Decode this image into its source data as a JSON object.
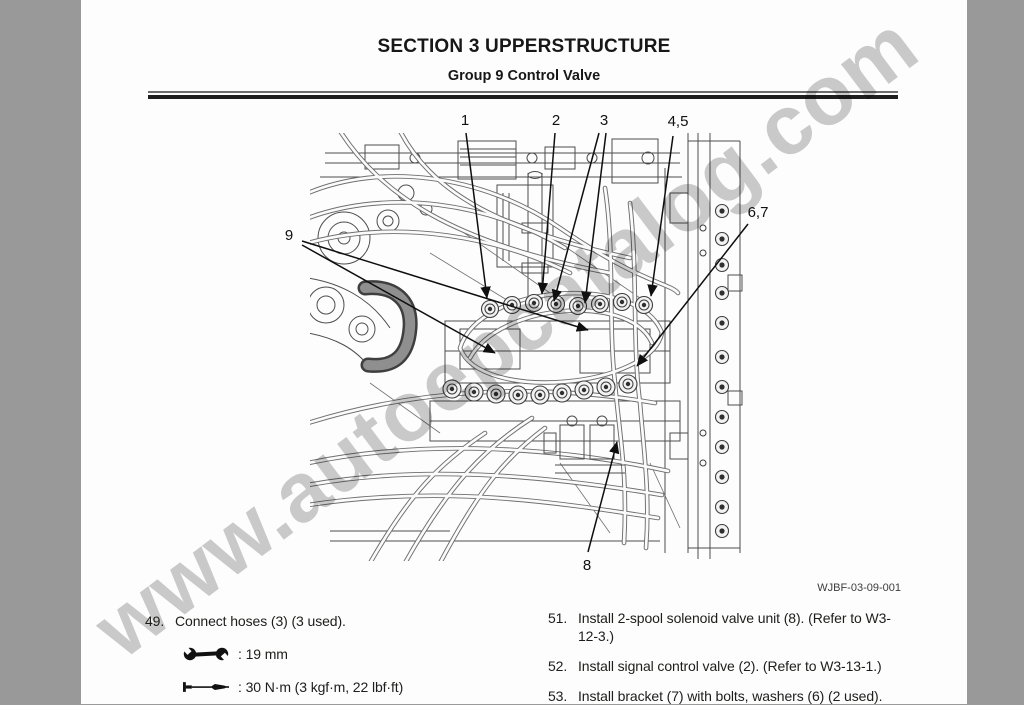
{
  "header": {
    "section_title": "SECTION 3 UPPERSTRUCTURE",
    "group_title": "Group 9 Control Valve"
  },
  "watermark": "www.autoepcatalog.com",
  "figure": {
    "code": "WJBF-03-09-001",
    "callouts": [
      {
        "label": "1"
      },
      {
        "label": "2"
      },
      {
        "label": "3"
      },
      {
        "label": "4,5"
      },
      {
        "label": "6,7"
      },
      {
        "label": "8"
      },
      {
        "label": "9"
      }
    ]
  },
  "steps": {
    "left": [
      {
        "number": "49.",
        "text": "Connect hoses (3) (3 used).",
        "tools": [
          {
            "icon": "wrench-icon",
            "value": ": 19 mm"
          },
          {
            "icon": "torque-wrench-icon",
            "value": ": 30 N·m (3 kgf·m, 22 lbf·ft)"
          }
        ]
      }
    ],
    "right": [
      {
        "number": "51.",
        "text": "Install 2-spool solenoid valve unit (8). (Refer to W3-12-3.)"
      },
      {
        "number": "52.",
        "text": "Install signal control valve (2). (Refer to W3-13-1.)"
      },
      {
        "number": "53.",
        "text": "Install bracket (7) with bolts, washers (6) (2 used)."
      }
    ]
  },
  "colors": {
    "canvas_gray": "#999999",
    "text": "#1d1d1b",
    "watermark_gray": "#bdbdbd"
  }
}
